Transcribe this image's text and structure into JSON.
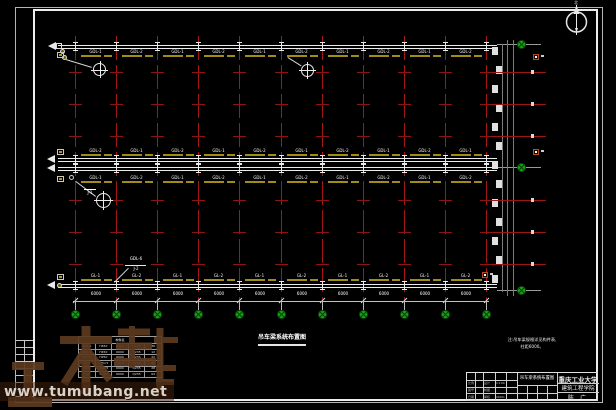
{
  "watermark": {
    "logo_text": "土木帮",
    "url_text": "www.tumubang.net"
  },
  "north": {
    "label": "北"
  },
  "plan": {
    "title": "吊车梁系统布置图",
    "note_line1": "注:吊车梁规格详见构件表,",
    "note_line2": "柱距6000。",
    "bay_labels": {
      "top": [
        "GDL-1",
        "GDL-2",
        "GDL-1",
        "GDL-2",
        "GDL-1",
        "GDL-2",
        "GDL-1",
        "GDL-2",
        "GDL-1",
        "GDL-2"
      ],
      "mid_upper": [
        "GDL-2",
        "GDL-1",
        "GDL-2",
        "GDL-1",
        "GDL-2",
        "GDL-1",
        "GDL-2",
        "GDL-1",
        "GDL-2",
        "GDL-1"
      ],
      "mid_lower": [
        "GDL-1",
        "GDL-2",
        "GDL-1",
        "GDL-2",
        "GDL-1",
        "GDL-2",
        "GDL-1",
        "GDL-2",
        "GDL-1",
        "GDL-2"
      ],
      "bottom": [
        "GL-1",
        "GL-2",
        "GL-1",
        "GL-2",
        "GL-1",
        "GL-2",
        "GL-1",
        "GL-2",
        "GL-1",
        "GL-2"
      ]
    },
    "span_dims": [
      "6000",
      "6000",
      "6000",
      "6000",
      "6000",
      "6000",
      "6000",
      "6000",
      "6000",
      "6000"
    ],
    "callouts": {
      "mid_label": "J-1",
      "bottom_top": "GDL-6",
      "bottom_bottom": "J-2"
    }
  },
  "schedule_table": {
    "title": "构件表",
    "rows": [
      [
        "GDL-1",
        "H450",
        "6000",
        "Q235",
        "36"
      ],
      [
        "GDL-2",
        "H450",
        "6000",
        "Q235",
        "12"
      ],
      [
        "GL-1",
        "H250",
        "6000",
        "Q235",
        "22"
      ],
      [
        "ZC-1",
        "L75×5",
        "7210",
        "Q235",
        "40"
      ],
      [
        "SC-1",
        "L63×5",
        "6000",
        "Q235",
        "28"
      ],
      [
        "C-1",
        "C160",
        "6000",
        "Q235",
        "64"
      ]
    ]
  },
  "title_block": {
    "drawing_name": "吊车梁系统布置图",
    "university": "重庆工业大学",
    "department": "建筑工程学院",
    "author": "陈 广",
    "design_label": "设计",
    "draft_label": "制图",
    "review_label": "审核",
    "date_label": "日期",
    "scale_label": "比例",
    "no_label": "图号",
    "scale_value": "1:100",
    "date_value": "2004.6"
  }
}
